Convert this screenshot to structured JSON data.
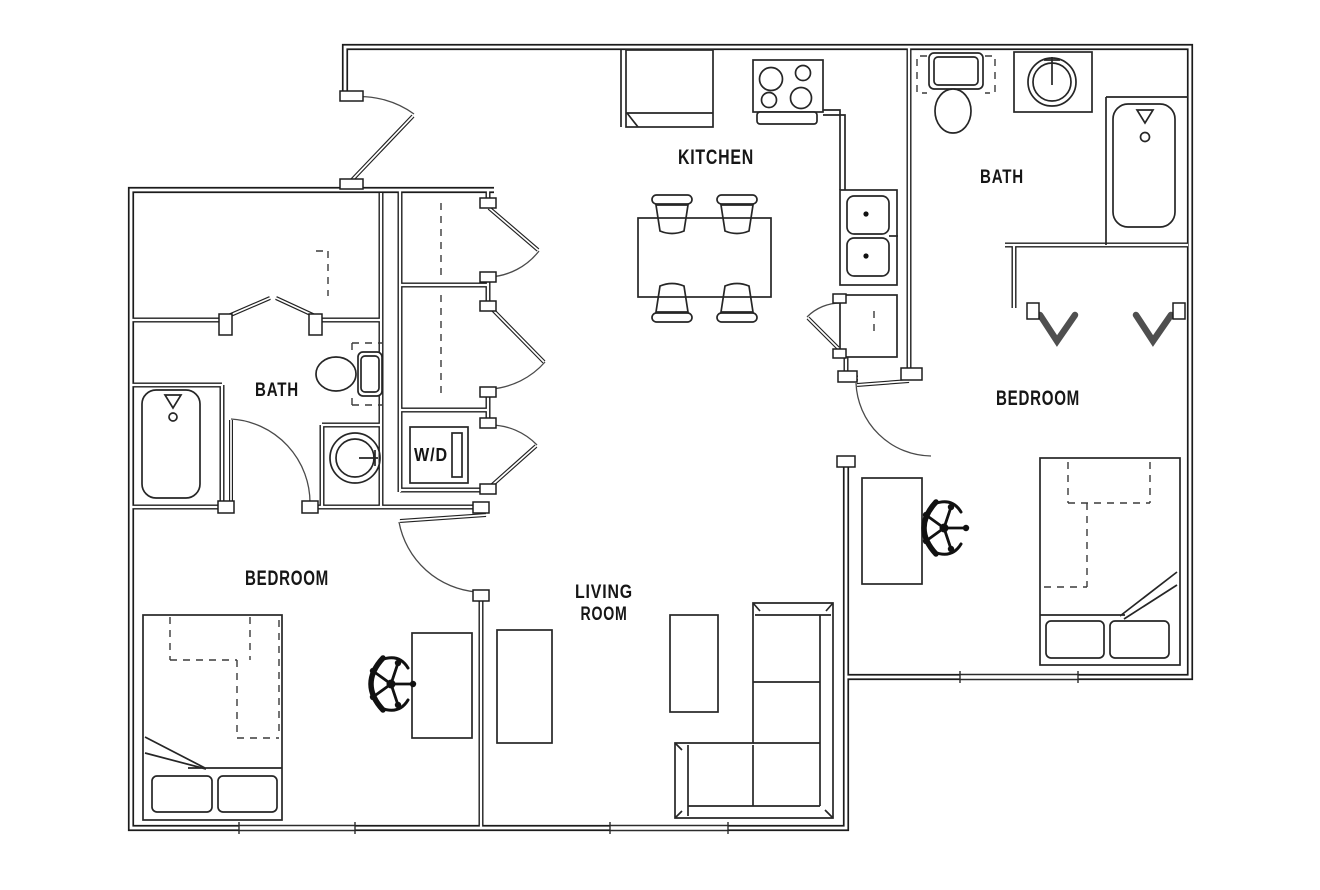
{
  "meta": {
    "type": "apartment-floor-plan",
    "background": "#ffffff",
    "ink": "#1f1f1f"
  },
  "rooms": {
    "kitchen": {
      "label": "KITCHEN"
    },
    "bath_upper": {
      "label": "BATH"
    },
    "bedroom_upper": {
      "label": "BEDROOM"
    },
    "bath_lower": {
      "label": "BATH"
    },
    "bedroom_lower": {
      "label": "BEDROOM"
    },
    "living_room": {
      "label_line1": "LIVING",
      "label_line2": "ROOM"
    },
    "laundry": {
      "label": "W/D"
    }
  }
}
